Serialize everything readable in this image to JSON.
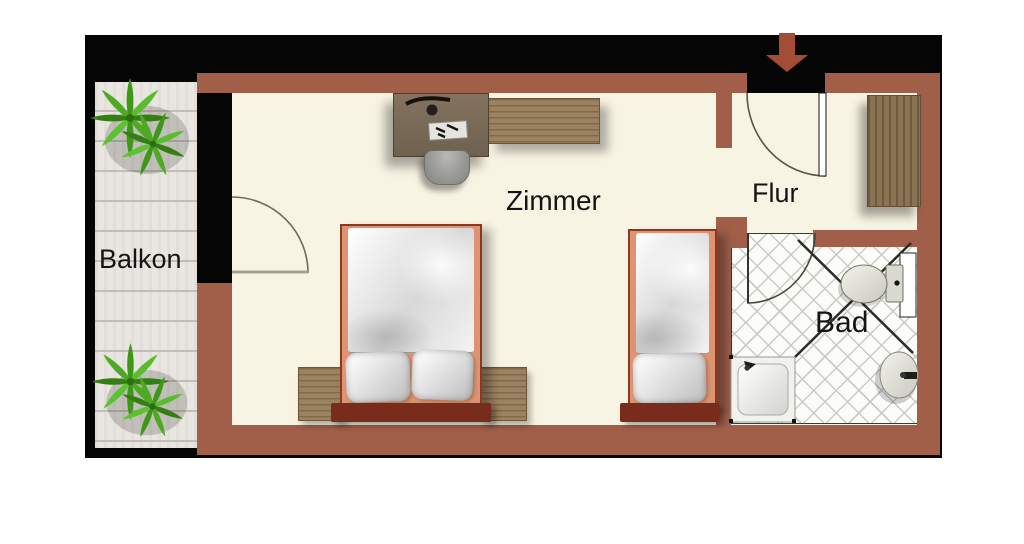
{
  "rooms": [
    {
      "key": "balkon",
      "label": "Balkon"
    },
    {
      "key": "zimmer",
      "label": "Zimmer"
    },
    {
      "key": "flur",
      "label": "Flur"
    },
    {
      "key": "bad",
      "label": "Bad"
    }
  ],
  "entrance": {
    "symbol": "entrance-arrow",
    "direction": "down"
  },
  "furniture": {
    "zimmer": [
      "double-bed",
      "nightstand-left",
      "nightstand-right",
      "single-bed",
      "desk",
      "desk-chair",
      "dresser"
    ],
    "flur": [
      "wardrobe",
      "entrance-door"
    ],
    "bad": [
      "shower",
      "toilet",
      "sink",
      "bathroom-door"
    ],
    "balkon": [
      "plant",
      "plant"
    ]
  },
  "colors": {
    "wall": "#a15f4a",
    "floor": "#f8f4e3",
    "window_wall": "#050505",
    "balcony_deck": "#e9e6e1",
    "bathroom_tile": "#fcfcf9",
    "entrance_arrow": "#a34d36",
    "bed_frame": "#8d3722",
    "headboard": "#792c1b",
    "wood": "#9c8260",
    "plant_green": "#46a21e"
  }
}
